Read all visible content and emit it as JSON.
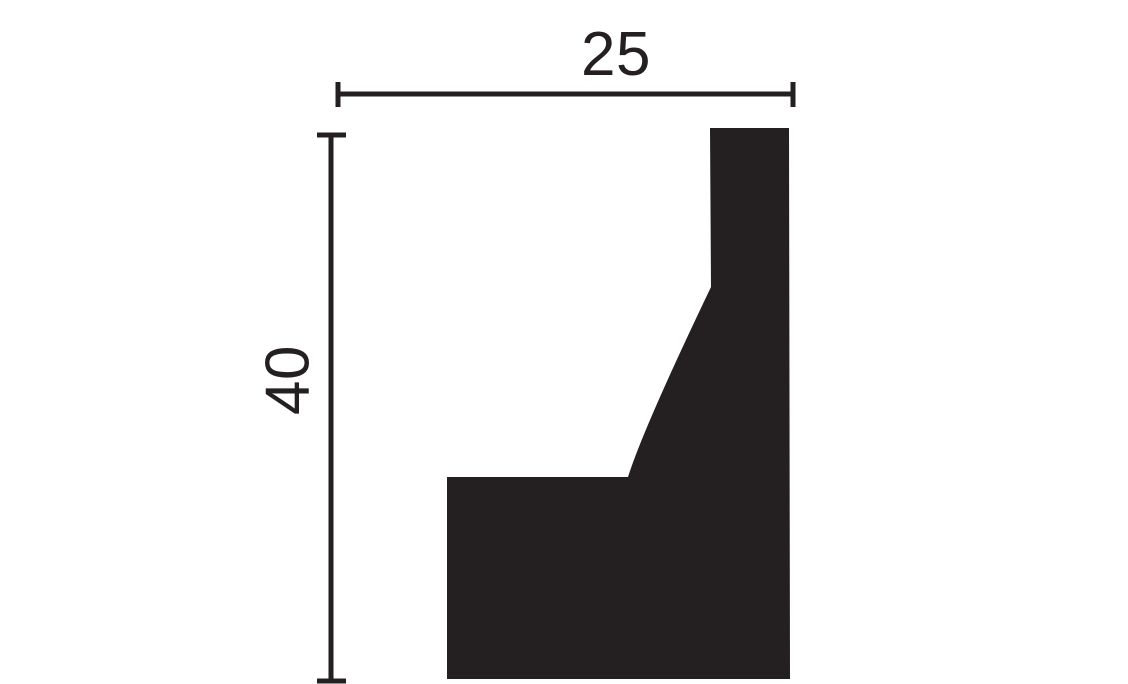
{
  "diagram": {
    "width_label": "25",
    "height_label": "40"
  },
  "colors": {
    "ink": "#241f21",
    "background": "#ffffff"
  }
}
